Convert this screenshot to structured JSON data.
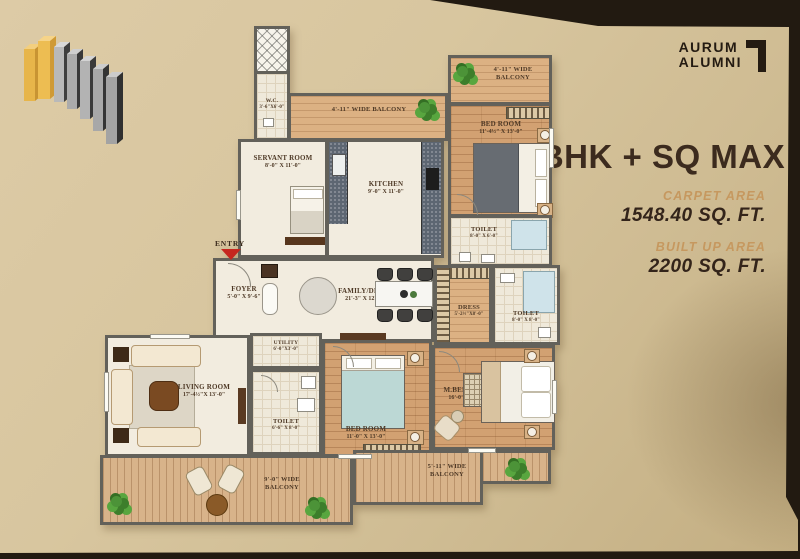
{
  "branding": {
    "brand_line1": "AURUM",
    "brand_line2": "ALUMNI"
  },
  "summary": {
    "title": "3BHK + SQ MAX",
    "carpet_area_label": "CARPET AREA",
    "carpet_area_value": "1548.40 SQ. FT.",
    "built_up_label": "BUILT UP AREA",
    "built_up_value": "2200 SQ. FT."
  },
  "plan": {
    "entry_label": "ENTRY",
    "rooms": {
      "wc": {
        "name": "W.C.",
        "dim": "3'-6\"X6'-0\""
      },
      "balcony_tl": {
        "name": "4'-11\" WIDE BALCONY"
      },
      "balcony_tr": {
        "name": "4'-11\" WIDE BALCONY"
      },
      "servant": {
        "name": "SERVANT ROOM",
        "dim": "8'-0\" X 11'-0\""
      },
      "kitchen": {
        "name": "KITCHEN",
        "dim": "9'-0\" X 11'-0\""
      },
      "bedroom_top": {
        "name": "BED ROOM",
        "dim": "11'-4½\" X 13'-0\""
      },
      "toilet_top": {
        "name": "TOILET",
        "dim": "8'-0\" X 6'-0\""
      },
      "dress": {
        "name": "DRESS",
        "dim": "5'-2½\"X8'-0\""
      },
      "toilet_mid": {
        "name": "TOILET",
        "dim": "8'-0\" X 8'-0\""
      },
      "family": {
        "name": "FAMILY/DINING",
        "dim": "21'-3\" X 12'-4½\""
      },
      "foyer": {
        "name": "FOYER",
        "dim": "5'-0\" X 9'-6\""
      },
      "living": {
        "name": "LIVING ROOM",
        "dim": "17'-4½\"X 13'-0\""
      },
      "utility": {
        "name": "UTILITY",
        "dim": "6'-0\"X3'-0\""
      },
      "toilet_bottom": {
        "name": "TOILET",
        "dim": "6'-6\" X 8'-0\""
      },
      "bedroom_mid": {
        "name": "BED ROOM",
        "dim": "11'-0\" X 13'-0\""
      },
      "mbedroom": {
        "name": "M.BED ROOM",
        "dim": "16'-0\" X 13'-0\""
      },
      "balcony_bl": {
        "name": "9'-0\" WIDE BALCONY"
      },
      "balcony_br": {
        "name": "5'-11\" WIDE BALCONY"
      }
    }
  },
  "colors": {
    "accent_tan": "#c6985f",
    "title_brown": "#3c2b1e",
    "entry_arrow_red": "#c5261f",
    "logo_gold": "#e7b54a",
    "background_beige": "#d8c69f"
  }
}
